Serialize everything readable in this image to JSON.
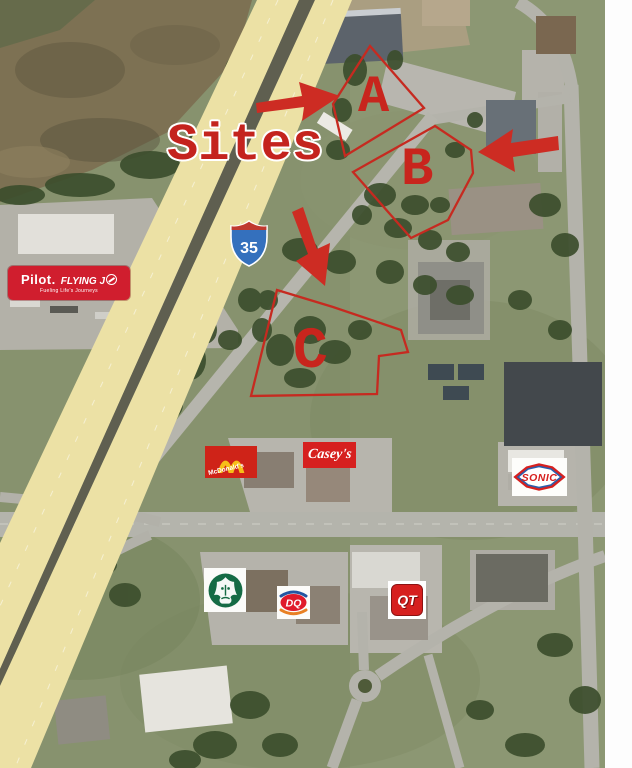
{
  "annotation": {
    "title": "Sites",
    "color": "#c8241f",
    "sites": [
      {
        "id": "site-a",
        "label": "A"
      },
      {
        "id": "site-b",
        "label": "B"
      },
      {
        "id": "site-c",
        "label": "C"
      }
    ],
    "arrows": [
      {
        "site": "A",
        "direction": "right"
      },
      {
        "site": "B",
        "direction": "left"
      },
      {
        "site": "C",
        "direction": "down"
      }
    ]
  },
  "highway": {
    "shield_number": "35",
    "shield_blue": "#3470bd",
    "shield_red": "#c0392f",
    "pavement_yellow": "#ece1a5"
  },
  "logos": {
    "pilot": {
      "brand": "Pilot.",
      "flying": "FLYING J",
      "tagline": "Fueling Life's Journeys",
      "bg": "#d01e2e"
    },
    "mcdonalds": {
      "label": "McDonald's",
      "bg": "#cf2318",
      "arches_yellow": "#f7bf17"
    },
    "caseys": {
      "label": "Casey's",
      "bg": "#d6201f"
    },
    "sonic": {
      "label": "SONIC",
      "text_red": "#d6201f",
      "outline_blue": "#2b5daa"
    },
    "starbucks": {
      "icon": "starbucks-siren",
      "green": "#156b45"
    },
    "dq": {
      "label": "DQ",
      "red": "#e01a2b",
      "blue": "#2456a2",
      "orange": "#e88024"
    },
    "qt": {
      "label": "QT",
      "red": "#d6201f"
    }
  }
}
